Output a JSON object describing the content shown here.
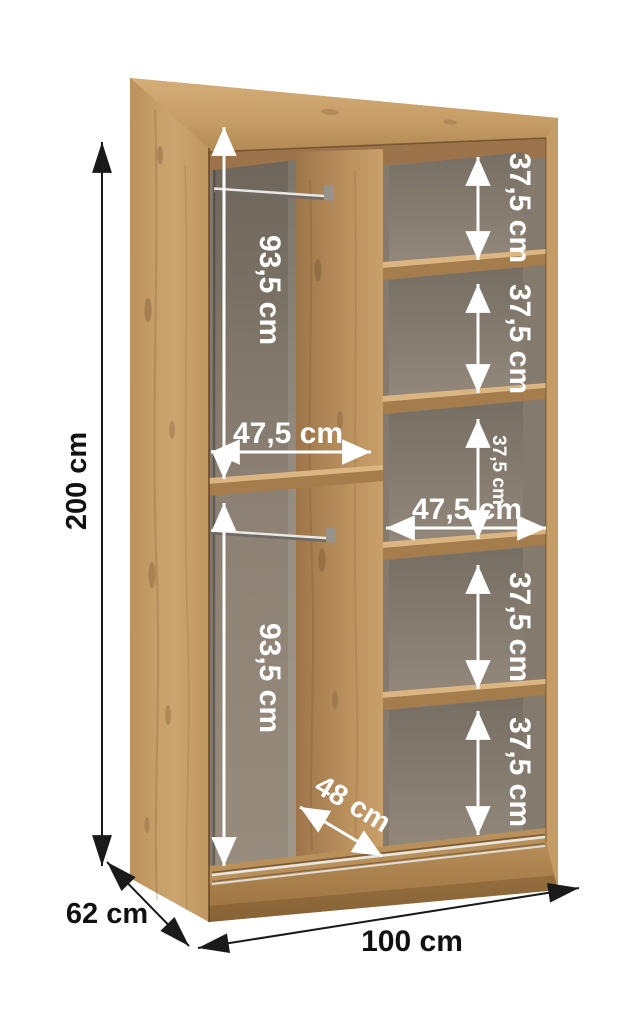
{
  "dimensions": {
    "height": "200 cm",
    "depth": "62 cm",
    "width": "100 cm",
    "upper_hanging_height": "93,5 cm",
    "lower_hanging_height": "93,5 cm",
    "left_compartment_width": "47,5 cm",
    "right_compartment_width": "47,5 cm",
    "usable_depth": "48 cm",
    "shelf_spacings": [
      "37,5 cm",
      "37,5 cm",
      "37,5 cm",
      "37,5 cm",
      "37,5 cm"
    ]
  },
  "colors": {
    "wood": "#c49a64",
    "wood_light": "#d2ab76",
    "wood_dark": "#a0774a",
    "interior_back": "#8d8276",
    "arrow_white": "#ffffff",
    "arrow_black": "#1a1a1a",
    "background": "#ffffff"
  }
}
